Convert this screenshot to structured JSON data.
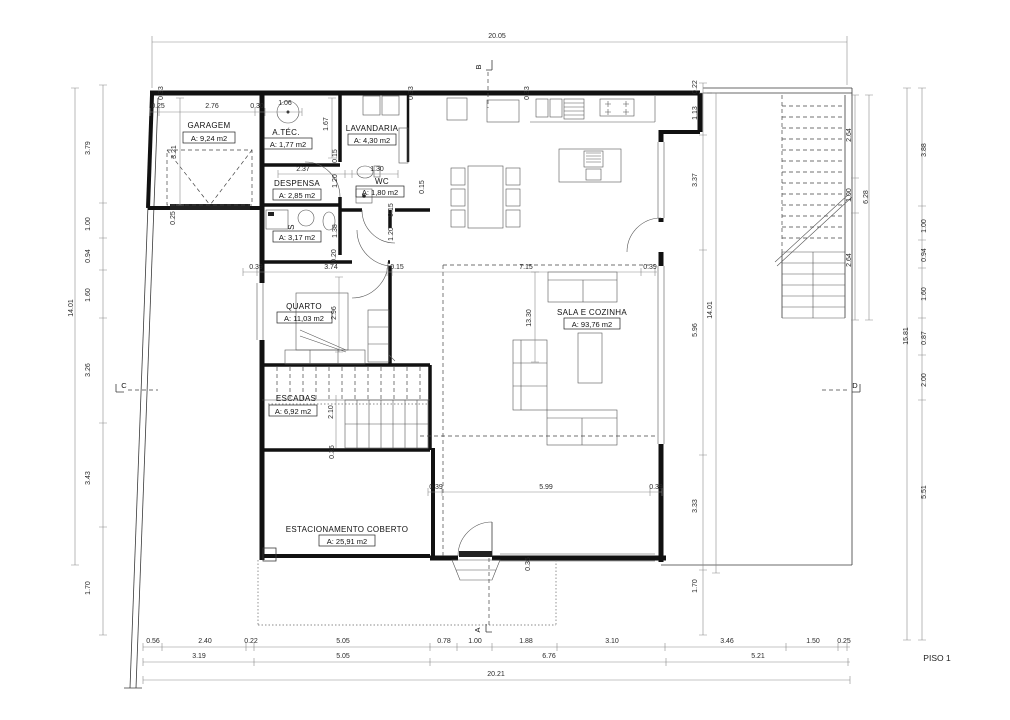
{
  "sheet": {
    "label": "PISO 1"
  },
  "markers": {
    "a": "A",
    "b": "B",
    "c": "C",
    "d": "D"
  },
  "rooms": {
    "garagem": {
      "name": "GARAGEM",
      "area": "A: 9,24 m2"
    },
    "atec": {
      "name": "A.TÉC.",
      "area": "A: 1,77 m2"
    },
    "lavandaria": {
      "name": "LAVANDARIA",
      "area": "A: 4,30 m2"
    },
    "despensa": {
      "name": "DESPENSA",
      "area": "A: 2,85 m2"
    },
    "wc": {
      "name": "WC",
      "area": "A: 1,80 m2"
    },
    "s": {
      "name": "S",
      "area": "A: 3,17 m2"
    },
    "quarto": {
      "name": "QUARTO",
      "area": "A: 11,03 m2"
    },
    "escadas": {
      "name": "ESCADAS",
      "area": "A: 6,92 m2"
    },
    "sala": {
      "name": "SALA E COZINHA",
      "area": "A: 93,76 m2"
    },
    "estacionamento": {
      "name": "ESTACIONAMENTO COBERTO",
      "area": "A: 25,91 m2"
    }
  },
  "dims": {
    "top_total": "20.05",
    "bottom_total": "20.21",
    "left_total": "14.01",
    "right_total": "14.01",
    "stair_total": "6.28",
    "far_total": "15.81",
    "top_chain": [
      "0.25",
      "2.76",
      "0.30",
      "1.06"
    ],
    "top_vert": [
      "0.33",
      "0.33",
      "0.33"
    ],
    "left_chain": [
      "3.79",
      "1.00",
      "0.94",
      "1.60",
      "3.26",
      "3.43",
      "1.70"
    ],
    "right_chain": [
      "0.22",
      "1.13",
      "3.37",
      "5.96",
      "3.33",
      "1.70"
    ],
    "stair_chain": [
      "2.64",
      "1.00",
      "2.64"
    ],
    "far_chain": [
      "3.88",
      "1.00",
      "0.94",
      "1.60",
      "0.87",
      "2.00",
      "5.51"
    ],
    "bottom1": [
      "0.56",
      "2.40",
      "0.22",
      "5.05",
      "0.78",
      "1.00",
      "1.88",
      "3.10",
      "3.46",
      "1.50",
      "0.25"
    ],
    "bottom2": [
      "3.19",
      "5.05",
      "6.76",
      "5.21"
    ],
    "mid": [
      "0.39",
      "3.74",
      "0.15",
      "7.15",
      "0.39"
    ],
    "lower": [
      "0.39",
      "5.99",
      "0.39"
    ],
    "interior": {
      "garage_h": "3.21",
      "garage_b": "0.25",
      "despensa_w": "2.37",
      "wc_w": "1.30",
      "tec_h": "1.67",
      "d1a": "0.15",
      "d1b": "1.20",
      "s_h": "1.38",
      "p20": "0.20",
      "d2a": "0.15",
      "d2b": "1.20",
      "d3": "0.15",
      "quarto_h": "2.96",
      "sala_h": "13.30",
      "esc_h": "2.10",
      "esc_b": "0.36",
      "entry": "0.36"
    }
  }
}
